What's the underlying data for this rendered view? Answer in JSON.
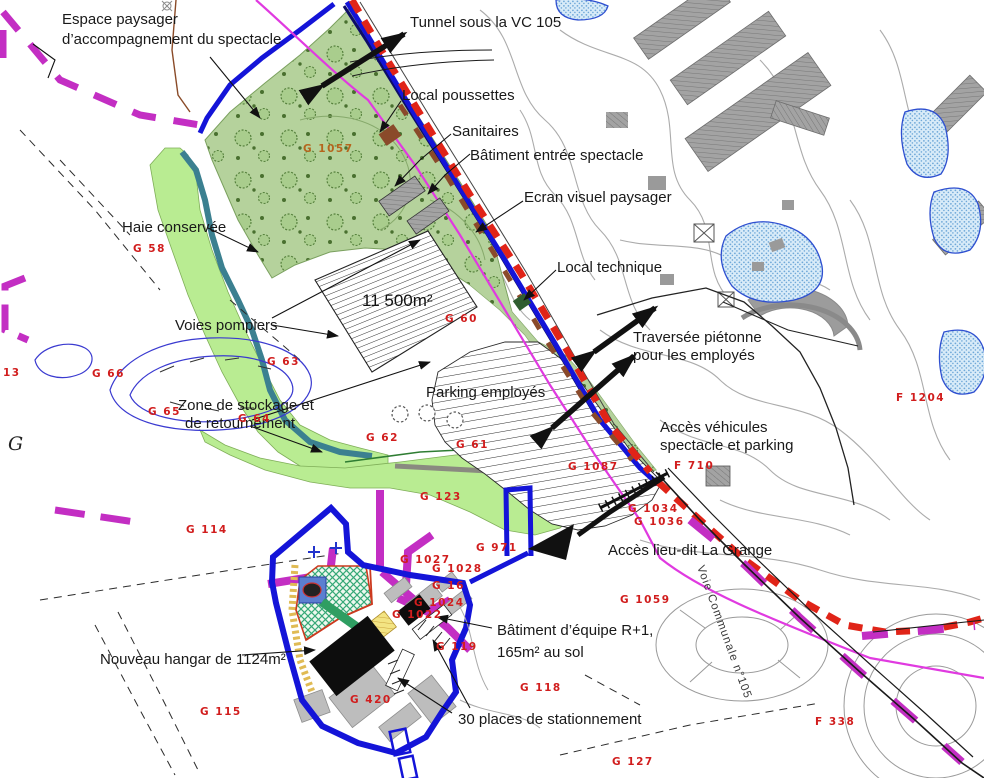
{
  "labels": {
    "espace_1": "Espace paysager",
    "espace_2": "d’accompagnement du spectacle",
    "tunnel": "Tunnel sous la VC 105",
    "poussettes": "Local poussettes",
    "sanitaires": "Sanitaires",
    "batiment_entree": "Bâtiment entrée spectacle",
    "ecran": "Ecran visuel paysager",
    "local_technique": "Local technique",
    "haie": "Haie conservée",
    "voies_pompiers": "Voies pompiers",
    "surface": "11 500m²",
    "zone_1": "Zone de stockage et",
    "zone_2": "de retournement",
    "parking": "Parking employés",
    "traversee_1": "Traversée piétonne",
    "traversee_2": "pour les employés",
    "acces_vehicules_1": "Accès véhicules",
    "acces_vehicules_2": "spectacle et parking",
    "acces_grange": "Accès lieu-dit La Grange",
    "batiment_equipe_1": "Bâtiment d’équipe R+1,",
    "batiment_equipe_2": "165m² au sol",
    "hangar": "Nouveau hangar de 1124m²",
    "stationnement": "30 places de stationnement",
    "voie_communale": "Voie Communale n°105",
    "section_g": "G"
  },
  "parcels": {
    "g1057": "G 1057",
    "g58": "G 58",
    "g63": "G 63",
    "g66": "G 66",
    "g65": "G 65",
    "g64": "G 64",
    "g60": "G 60",
    "g62": "G 62",
    "g61": "G 61",
    "g1087": "G 1087",
    "g123": "G 123",
    "g114": "G 114",
    "g115": "G 115",
    "g420": "G 420",
    "g119": "G 119",
    "g118": "G 118",
    "g127": "G 127",
    "g971": "G 971",
    "g1027": "G 1027",
    "g1028": "G 1028",
    "g16": "G 16",
    "g1022": "G 1022",
    "g1024": "G 1024",
    "g1034": "G 1034",
    "g1036": "G 1036",
    "g1059": "G 1059",
    "g13": "13",
    "f710": "F 710",
    "f1204": "F 1204",
    "f338": "F 338"
  },
  "colors": {
    "boundary_blue": "#1414d8",
    "limit_red": "#e02418",
    "magenta_dash": "#c32ec3",
    "magenta_thin": "#e03ae0",
    "trees_green": "#b5d29c",
    "hedge_green": "#b9ec92",
    "teal_hedge": "#3b8090",
    "parcel_red": "#d11d1d",
    "navy_line": "#0d0d66"
  }
}
